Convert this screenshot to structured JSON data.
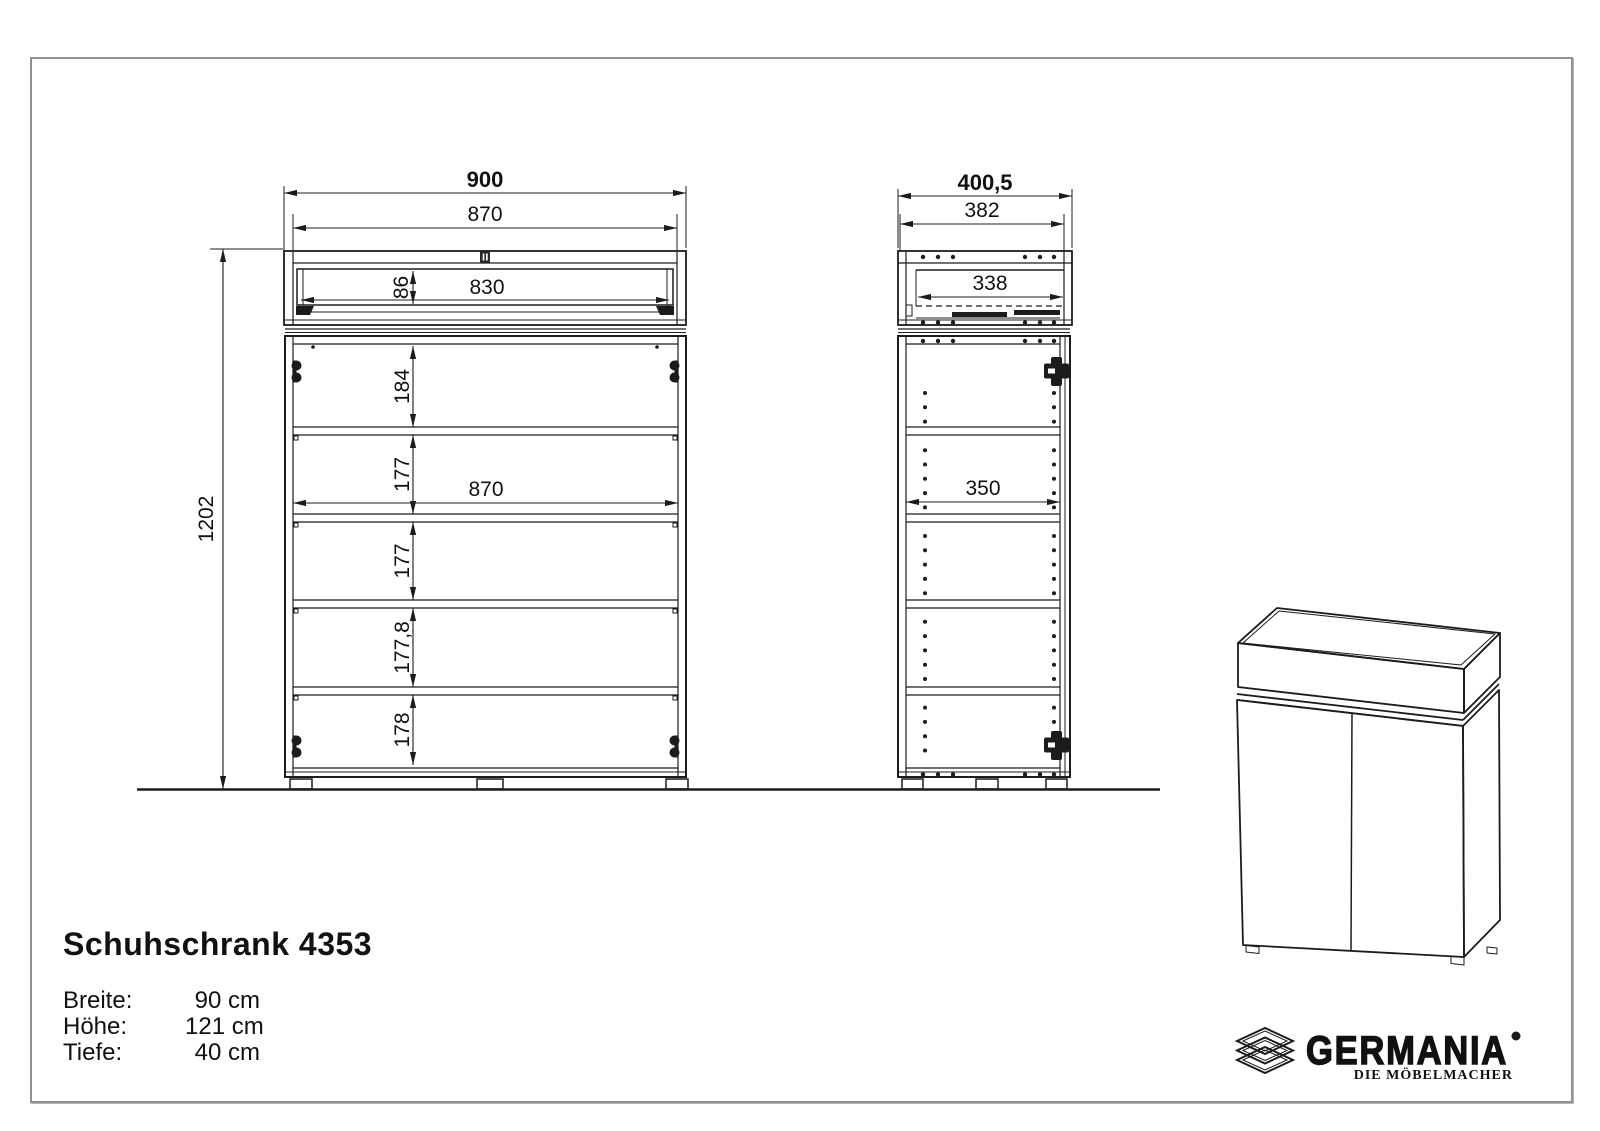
{
  "dims": {
    "front": {
      "overall_width": "900",
      "carcass_width": "870",
      "drawer_height": "86",
      "drawer_width": "830",
      "comp": [
        "184",
        "177",
        "177",
        "177,8",
        "178"
      ],
      "inner_width": "870",
      "overall_height": "1202"
    },
    "side": {
      "overall_depth": "400,5",
      "carcass_depth": "382",
      "drawer_depth": "338",
      "shelf_depth": "350"
    }
  },
  "title_block": {
    "title": "Schuhschrank 4353",
    "specs": [
      {
        "label": "Breite:",
        "value": "90 cm"
      },
      {
        "label": "Höhe:",
        "value": "121 cm"
      },
      {
        "label": "Tiefe:",
        "value": "40 cm"
      }
    ]
  },
  "brand": {
    "name": "GERMANIA",
    "tagline": "DIE MÖBELMACHER",
    "icon": "layered-sheets-icon"
  },
  "colors": {
    "line": "#1c1c1c",
    "frame": "#919191"
  }
}
